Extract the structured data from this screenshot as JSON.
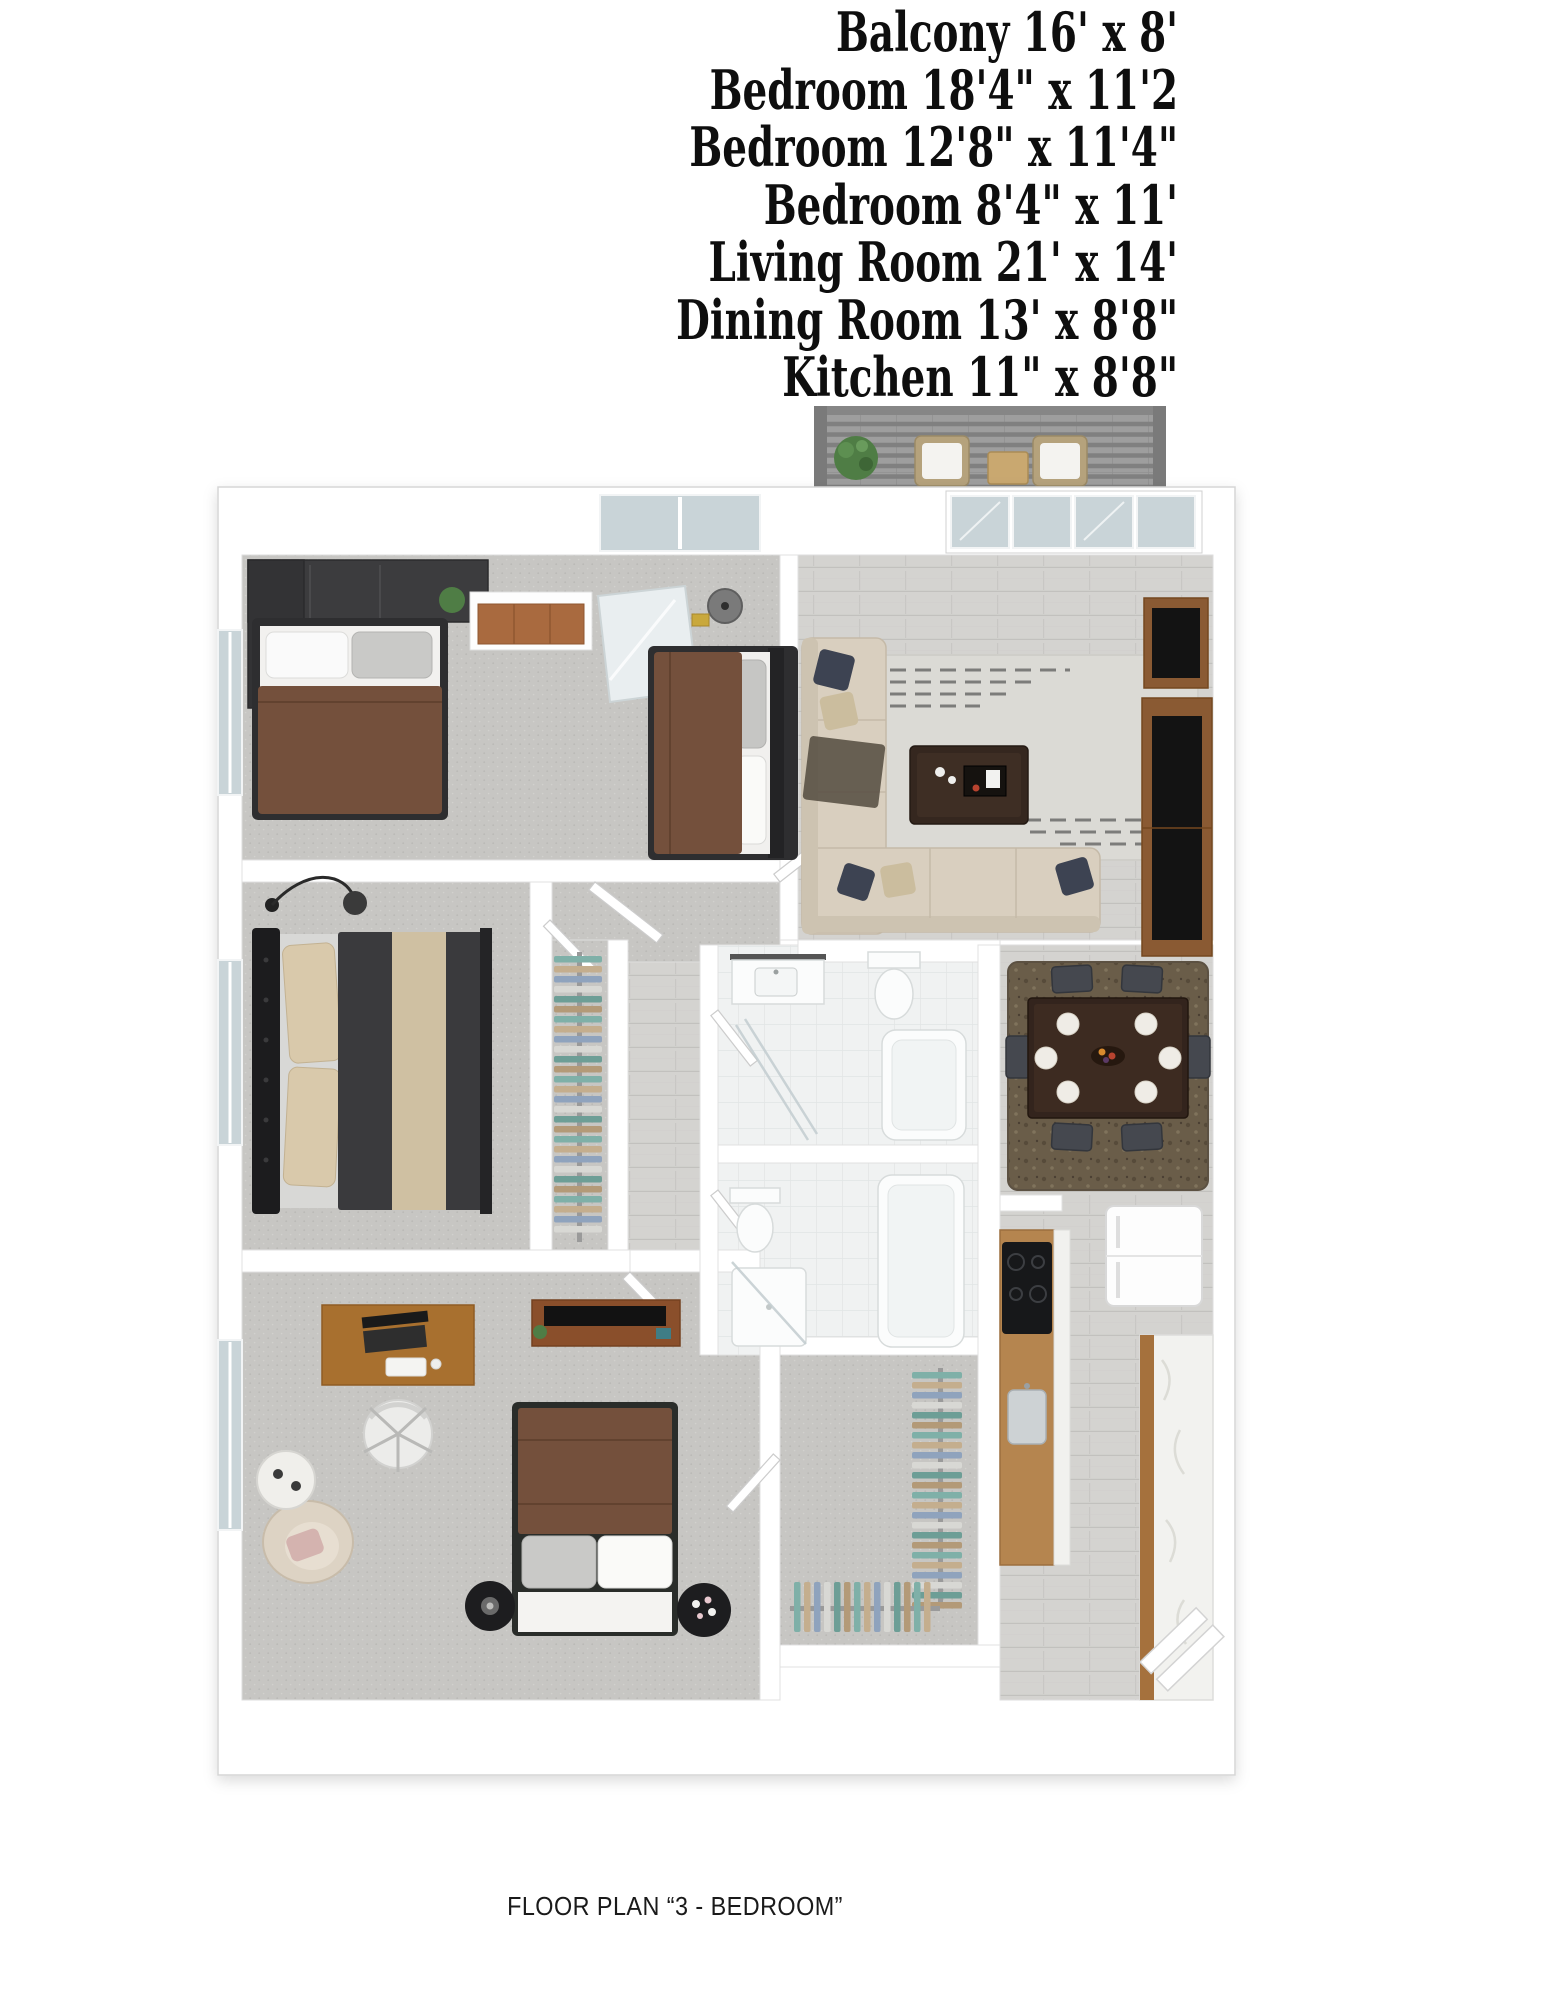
{
  "room_list": {
    "items": [
      {
        "label": "Balcony",
        "dimensions": "16' x 8'",
        "text": "Balcony 16' x 8'"
      },
      {
        "label": "Bedroom",
        "dimensions": "18'4\" x 11'2",
        "text": "Bedroom 18'4\" x 11'2"
      },
      {
        "label": "Bedroom",
        "dimensions": "12'8\" x 11'4\"",
        "text": "Bedroom 12'8\" x 11'4\""
      },
      {
        "label": "Bedroom",
        "dimensions": "8'4\" x 11'",
        "text": "Bedroom 8'4\" x 11'"
      },
      {
        "label": "Living Room",
        "dimensions": "21' x 14'",
        "text": "Living Room 21' x 14'"
      },
      {
        "label": "Dining Room",
        "dimensions": "13' x 8'8\"",
        "text": "Dining Room 13' x 8'8\""
      },
      {
        "label": "Kitchen",
        "dimensions": "11\" x 8'8\"",
        "text": "Kitchen 11\" x 8'8\""
      }
    ]
  },
  "caption": "FLOOR PLAN “3 - BEDROOM”",
  "floor_plan": {
    "type": "3d-rendered apartment floor plan, top-down view",
    "rooms": [
      "balcony",
      "bedroom-shared",
      "living-room",
      "master-bedroom",
      "bedroom-bottom",
      "bathroom-1",
      "bathroom-2",
      "walk-in-closet",
      "hallway",
      "dining-area",
      "kitchen",
      "entry"
    ],
    "colors": {
      "wallEdge": "#d6d6d6",
      "carpet": "#c7c6c3",
      "wood": "#d4d3d0",
      "tile": "#f0f2f2",
      "balconyFloor": "#9e9e9e",
      "pergola": "#808080",
      "glass": "#c9d4d8",
      "bedBrown": "#74503c",
      "bedFrameDark": "#2e2e30",
      "masterBlanket": "#3a3a3d",
      "throwBeige": "#cfc0a2",
      "pillowBeige": "#d9c9ab",
      "sofa": "#d9cfbf",
      "pillowNavy": "#3d4352",
      "rugLight": "#dbdad5",
      "rugBrown": "#6a5d49",
      "tableDark": "#33241d",
      "chairDark": "#45484f",
      "dresserWood": "#a96a3f",
      "deskWood": "#a8702f",
      "consoleWood": "#8a5a33",
      "kitchenWood": "#b5854f",
      "counterMarble": "#f2f2ef",
      "clothesTeal": "#7fb0a8",
      "clothesBlue": "#8fa3bd",
      "clothesTan": "#c4ae8e",
      "plantGreen": "#4f7d45",
      "tvBlack": "#131313"
    }
  }
}
